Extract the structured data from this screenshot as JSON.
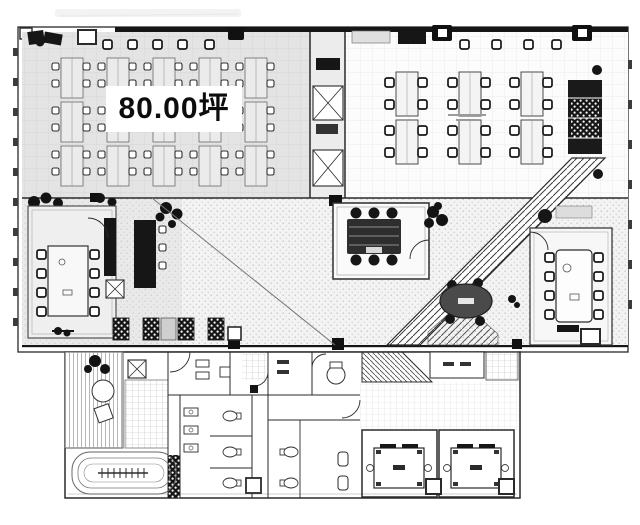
{
  "plan": {
    "area_label": "80.00坪",
    "colors": {
      "paper": "#ffffff",
      "wall": "#2a2a2a",
      "zone_gray": "#e4e4e4",
      "open_floor": "#f3f3f3",
      "furniture_dark": "#161616",
      "hatch_line": "#3d3d3d"
    }
  }
}
